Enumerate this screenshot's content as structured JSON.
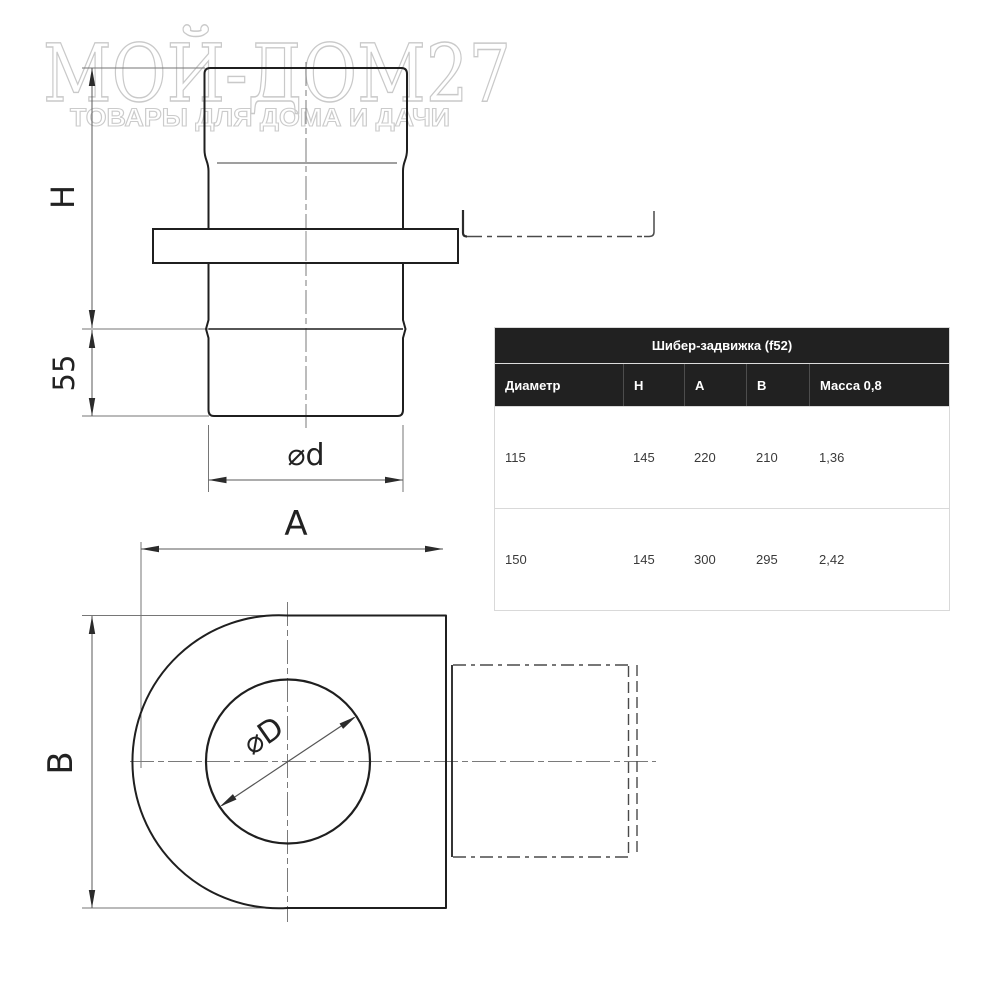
{
  "watermark": {
    "title": "МОЙ-ДОМ27",
    "subtitle": "ТОВАРЫ ДЛЯ ДОМА И ДАЧИ"
  },
  "drawing": {
    "front_view": {
      "height_label": "H",
      "collar_height_label": "55",
      "diameter_label": "⌀d"
    },
    "top_view": {
      "width_label": "A",
      "depth_label": "B",
      "diameter_label": "⌀D"
    }
  },
  "table": {
    "title": "Шибер-задвижка (f52)",
    "columns": [
      "Диаметр",
      "Н",
      "А",
      "В",
      "Масса 0,8"
    ],
    "rows": [
      [
        "115",
        "145",
        "220",
        "210",
        "1,36"
      ],
      [
        "150",
        "145",
        "300",
        "295",
        "2,42"
      ]
    ]
  },
  "colors": {
    "outline": "#1f1f1f",
    "dimension_line": "#5a5a5a",
    "thin_line": "#767676",
    "watermark": "#c9c9c9",
    "header_bg": "#212121",
    "table_border": "#d9d9d9"
  }
}
